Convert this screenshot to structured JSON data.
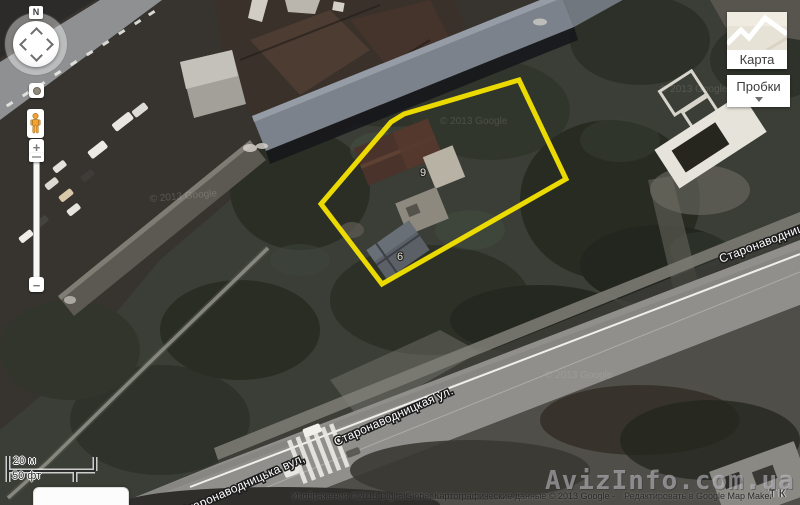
{
  "nav": {
    "north_label": "N",
    "zoom_in": "+",
    "zoom_out": "−"
  },
  "layer_buttons": {
    "map_label": "Карта",
    "traffic_label": "Пробки"
  },
  "scale_bar": {
    "metric": "20 м",
    "imperial": "50 фт"
  },
  "attribution": {
    "imagery": "Изображения ©2013 DigitalGlobe, Картографические данные © 2013 Google -",
    "edit_link": "Редактировать в Google Map Maker",
    "fragment": "ТК"
  },
  "watermark": {
    "site": "AvizInfo.com.ua"
  },
  "map_labels": {
    "street_center": "Старонаводницкая ул.",
    "street_bottom": "Старонаводницька вул,",
    "street_right": "Старонаводницька вул.",
    "house_number_9": "9",
    "house_number_6": "6",
    "imagery_watermark": "© 2013 Google"
  },
  "highlight": {
    "color": "#f6e400",
    "points": "519,80 566,179 382,284 321,204 391,122 404,114"
  },
  "colors": {
    "road": "#908f8b",
    "trees_dark": "#272b22",
    "roof_blue_gray": "#7b828b",
    "button_text": "#3c3c3c"
  }
}
